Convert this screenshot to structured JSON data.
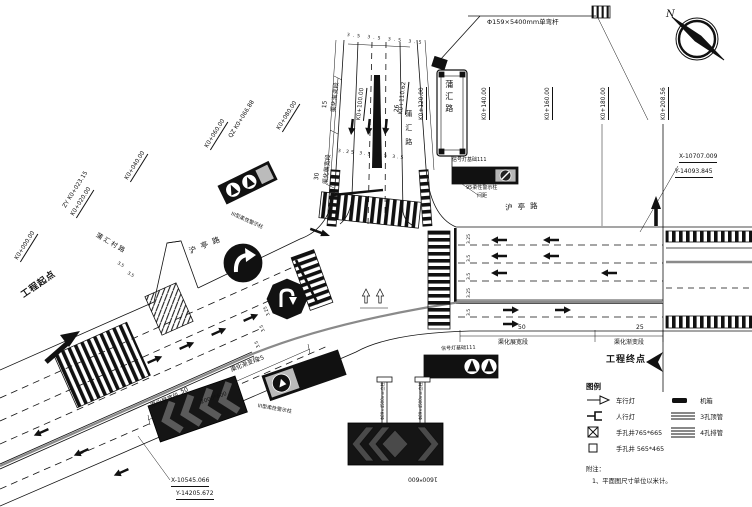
{
  "compass": {
    "label": "N"
  },
  "annotations": {
    "pole": "Φ159×5400mm单弯杆",
    "sign_road_name": "蒲汇路",
    "north_road_name": "蒲汇路",
    "east_road_name": "沪亭路",
    "west_road_name": "沪亭路",
    "side_road_name": "蒲汇村路",
    "project_start": "工程起点",
    "project_end": "工程终点"
  },
  "coordinates": {
    "start_x": "X-10545.066",
    "start_y": "Y-14205.672",
    "end_x": "X-10707.009",
    "end_y": "Y-14093.845"
  },
  "stations": [
    "K0+000.00",
    "K0+020.00",
    "ZY K0+023.15",
    "K0+040.00",
    "K0+060.00",
    "QZ K0+066.88",
    "K0+080.00",
    "K0+100.00",
    "K0+110.62",
    "K0+120.00",
    "K0+140.00",
    "K0+160.00",
    "K0+180.00",
    "K0+208.56"
  ],
  "segments": {
    "widen_label": "渠化展宽段",
    "taper_label": "渠化渐变段",
    "east_widen_len": "50",
    "east_taper_len": "25",
    "west_widen_len": "50",
    "west_taper_len": "25",
    "north_widen_len": "30",
    "north_taper_len": "15",
    "north_approach_len": "26"
  },
  "lane_dims": {
    "north_top": "3.5 3.5 3.5 3.5",
    "north_bottom": "3.25 3.5 3.5 3.5",
    "east": [
      "3.25",
      "3.5",
      "3.5",
      "3.25",
      "3.5"
    ],
    "west": [
      "3.25",
      "3.5",
      "3.5"
    ],
    "side": [
      "3.5",
      "3.5"
    ]
  },
  "callouts": {
    "signal_base_north": "信号灯基础111",
    "signal_base_south": "信号灯基础111",
    "flex_post": "95柔性警示柱",
    "flex_post_spacing": "间距",
    "warn_post_left": "III型柔性警示柱",
    "warn_post_bottom": "III型柔性警示柱",
    "chevron_board_size_small": "1600*600",
    "chevron_board_size_large": "2000*600",
    "post_spec": "Φ89×4500mm立柱"
  },
  "legend": {
    "title": "图例",
    "items": [
      {
        "label": "车行灯"
      },
      {
        "label": "人行灯"
      },
      {
        "label": "手孔井765*665"
      },
      {
        "label": "手孔井 565*465"
      },
      {
        "label": "机箱"
      },
      {
        "label": "3孔顶管"
      },
      {
        "label": "4孔排管"
      }
    ],
    "note_title": "附注：",
    "note_1": "1、平面图尺寸单位以米计。"
  }
}
